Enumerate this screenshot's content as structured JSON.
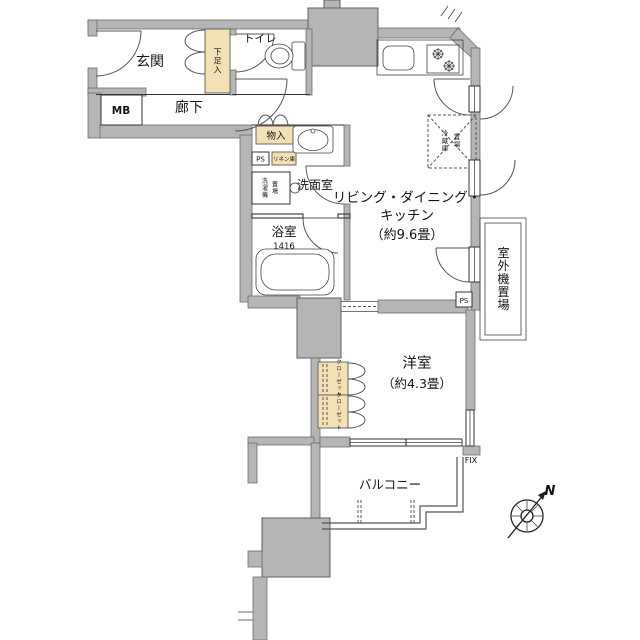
{
  "floor_plan": {
    "colors": {
      "wall_fill": "#b5b5b5",
      "storage_fill": "#f3e1b5",
      "line_color": "#333333",
      "background": "#ffffff"
    },
    "rooms": {
      "entrance": {
        "label": "玄関"
      },
      "toilet": {
        "label": "トイレ"
      },
      "shoe_cabinet": {
        "label": "下足入"
      },
      "meter_box": {
        "label": "MB"
      },
      "hallway": {
        "label": "廊下"
      },
      "storage": {
        "label": "物入"
      },
      "pipe_space": {
        "label": "PS"
      },
      "linen_cabinet": {
        "label": "リネン庫"
      },
      "washer_space": {
        "cols": [
          "洗濯機",
          "置場"
        ]
      },
      "washroom": {
        "label": "洗面室"
      },
      "bathroom": {
        "label": "浴室",
        "size_code": "1416"
      },
      "ldk": {
        "lines": [
          "リビング・ダイニング・",
          "キッチン",
          "（約9.6畳）"
        ]
      },
      "fridge_space": {
        "cols": [
          "冷蔵庫",
          "置場"
        ]
      },
      "outdoor_unit_space": {
        "label": "室外機置場"
      },
      "pipe_space_2": {
        "label": "PS"
      },
      "western_room": {
        "lines": [
          "洋室",
          "（約4.3畳）"
        ]
      },
      "closet_upper": {
        "label": "クローゼット"
      },
      "closet_lower": {
        "label": "クローゼット"
      },
      "balcony": {
        "label": "バルコニー"
      },
      "fix_window": {
        "label": "FIX"
      }
    },
    "compass": {
      "north_label": "N"
    }
  }
}
